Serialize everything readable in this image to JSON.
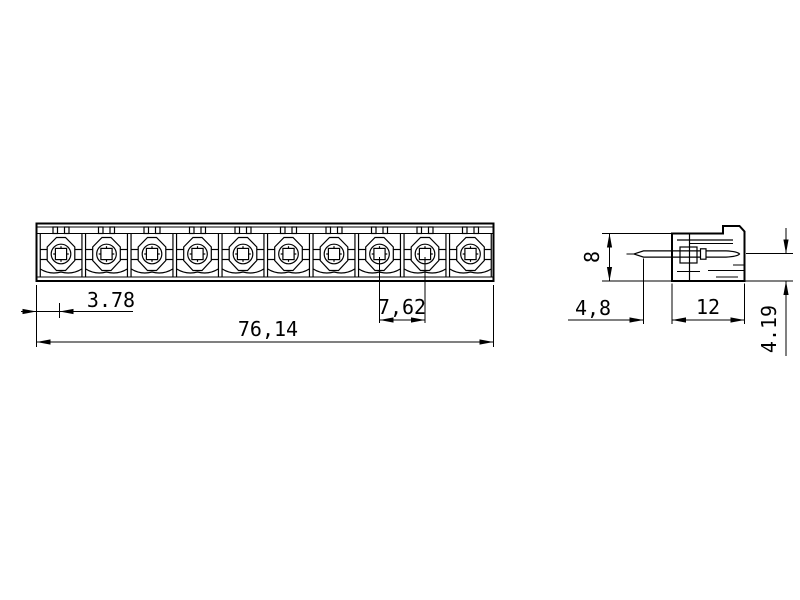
{
  "colors": {
    "background": "#ffffff",
    "line": "#000000"
  },
  "front_view": {
    "positions": 10,
    "dims": {
      "edge_to_first_pole": {
        "label": "3.78"
      },
      "pole_pitch": {
        "label": "7,62"
      },
      "overall_length": {
        "label": "76,14"
      }
    }
  },
  "side_view": {
    "dims": {
      "body_height": {
        "label": "8"
      },
      "pin_protrusion": {
        "label": "4,8"
      },
      "body_depth": {
        "label": "12"
      },
      "pin_axis_to_bottom": {
        "label": "4.19"
      }
    }
  }
}
